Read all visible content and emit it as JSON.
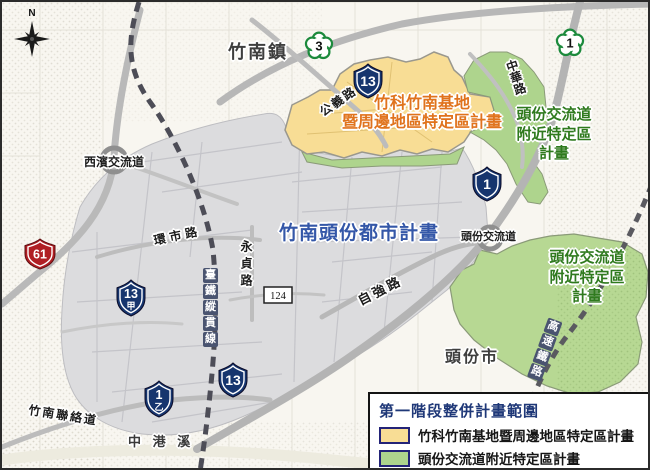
{
  "map": {
    "compass": "N",
    "towns": {
      "zhunan": "竹南鎮",
      "toufen": "頭份市"
    },
    "area_labels": {
      "science_park_line1": "竹科竹南基地",
      "science_park_line2": "暨周邊地區特定區計畫",
      "urban_plan": "竹南頭份都市計畫",
      "interchange_upper_line1": "頭份交流道",
      "interchange_upper_line2": "附近特定區",
      "interchange_upper_line3": "計畫",
      "interchange_lower_line1": "頭份交流道",
      "interchange_lower_line2": "附近特定區",
      "interchange_lower_line3": "計畫"
    },
    "road_labels": {
      "gongyi": "公義路",
      "zhonghua": "中華路",
      "huanshi": "環市路",
      "yongzhen": "永貞路",
      "ziqiang": "自強路",
      "zhunan_link": "竹南聯絡道",
      "zhonggang_creek": "中 港 溪",
      "xibin_ic": "西濱交流道",
      "toufen_ic": "頭份交流道"
    },
    "railway_labels": {
      "tra": [
        "臺",
        "鐵",
        "縱",
        "貫",
        "線"
      ],
      "hsr": [
        "高",
        "速",
        "鐵",
        "路"
      ]
    },
    "shields": {
      "national_3": "3",
      "national_1": "1",
      "provincial_13_top": "13",
      "provincial_1_mid": "1",
      "provincial_13jia": "13",
      "provincial_13jia_sub": "甲",
      "provincial_13_bottom": "13",
      "provincial_1yi": "1",
      "provincial_1yi_sub": "乙",
      "expressway_61": "61",
      "county_124": "124"
    }
  },
  "legend": {
    "title": "第一階段整併計畫範圍",
    "items": [
      {
        "label": "竹科竹南基地暨周邊地區特定區計畫",
        "color": "#f8dd95"
      },
      {
        "label": "頭份交流道附近特定區計畫",
        "color": "#aed48d"
      }
    ]
  },
  "colors": {
    "science_park_fill": "#f8dd95",
    "interchange_fill": "#aed48d",
    "urban_fill": "#dcdcde",
    "science_park_label": "#e0731d",
    "interchange_label": "#2f7a1e",
    "urban_label": "#3457a8",
    "legend_title": "#1f3878",
    "provincial_shield": "#16356e",
    "expressway_shield": "#b01f24",
    "national_shield": "#1c8a3c"
  }
}
